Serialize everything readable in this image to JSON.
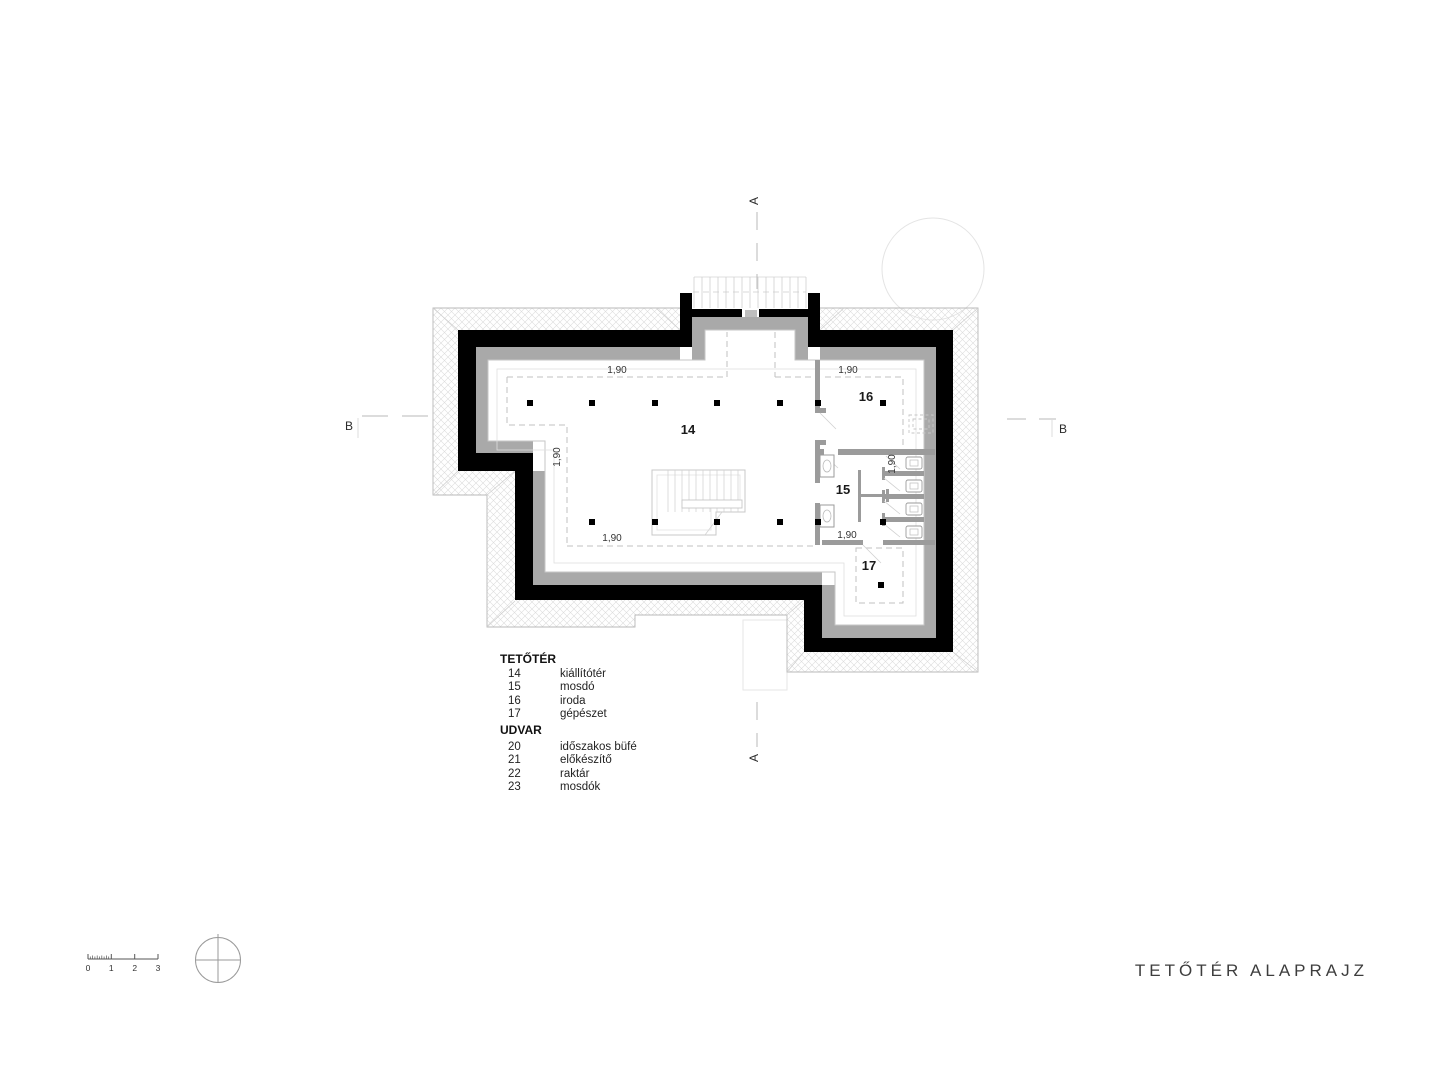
{
  "title_block": {
    "drawing_title": "TETŐTÉR ALAPRAJZ"
  },
  "legend": {
    "sections": [
      {
        "heading": "TETŐTÉR",
        "items": [
          {
            "num": "14",
            "label": "kiállítótér"
          },
          {
            "num": "15",
            "label": "mosdó"
          },
          {
            "num": "16",
            "label": "iroda"
          },
          {
            "num": "17",
            "label": "gépészet"
          }
        ]
      },
      {
        "heading": "UDVAR",
        "items": [
          {
            "num": "20",
            "label": "időszakos büfé"
          },
          {
            "num": "21",
            "label": "előkészítő"
          },
          {
            "num": "22",
            "label": "raktár"
          },
          {
            "num": "23",
            "label": "mosdók"
          }
        ]
      }
    ]
  },
  "plan": {
    "rooms": [
      {
        "num": "14"
      },
      {
        "num": "15"
      },
      {
        "num": "16"
      },
      {
        "num": "17"
      }
    ],
    "dim_label": "1,90",
    "markers": {
      "section_a": "A",
      "section_b": "B"
    }
  },
  "scale_bar": {
    "labels": [
      "0",
      "1",
      "2",
      "3"
    ]
  },
  "colors": {
    "wall": "#000000",
    "inner_band": "#a9a9a9",
    "partition": "#9b9b9b",
    "hatch_line": "#dcdcdc",
    "dash": "#c2c2c2",
    "text": "#1a1a1a"
  }
}
